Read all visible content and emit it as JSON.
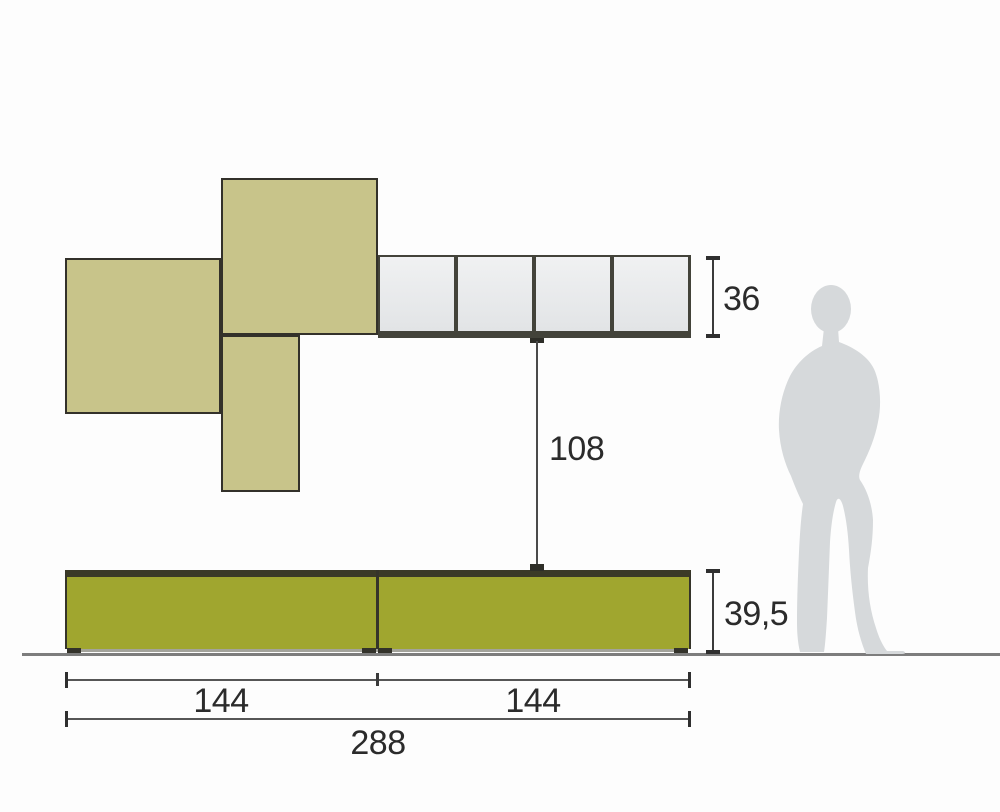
{
  "diagram": {
    "type": "furniture-dimension-diagram",
    "labels": {
      "upper_height": "36",
      "mid_gap": "108",
      "base_height": "39,5",
      "left_width": "144",
      "right_width": "144",
      "total_width": "288"
    },
    "upper_row": {
      "panel_count": 4
    },
    "base_cabinet": {
      "section_count": 2
    },
    "colors": {
      "khaki_cabinet": "#c8c48a",
      "olive_cabinet": "#a0a62f",
      "cabinet_frame": "#43433a",
      "panel_fill": "#e9ebec",
      "dimension_line": "#3a3a3a",
      "ground_line": "#7d7d7d",
      "silhouette": "#d6d9db"
    },
    "icons": {
      "person": "person-silhouette"
    }
  }
}
